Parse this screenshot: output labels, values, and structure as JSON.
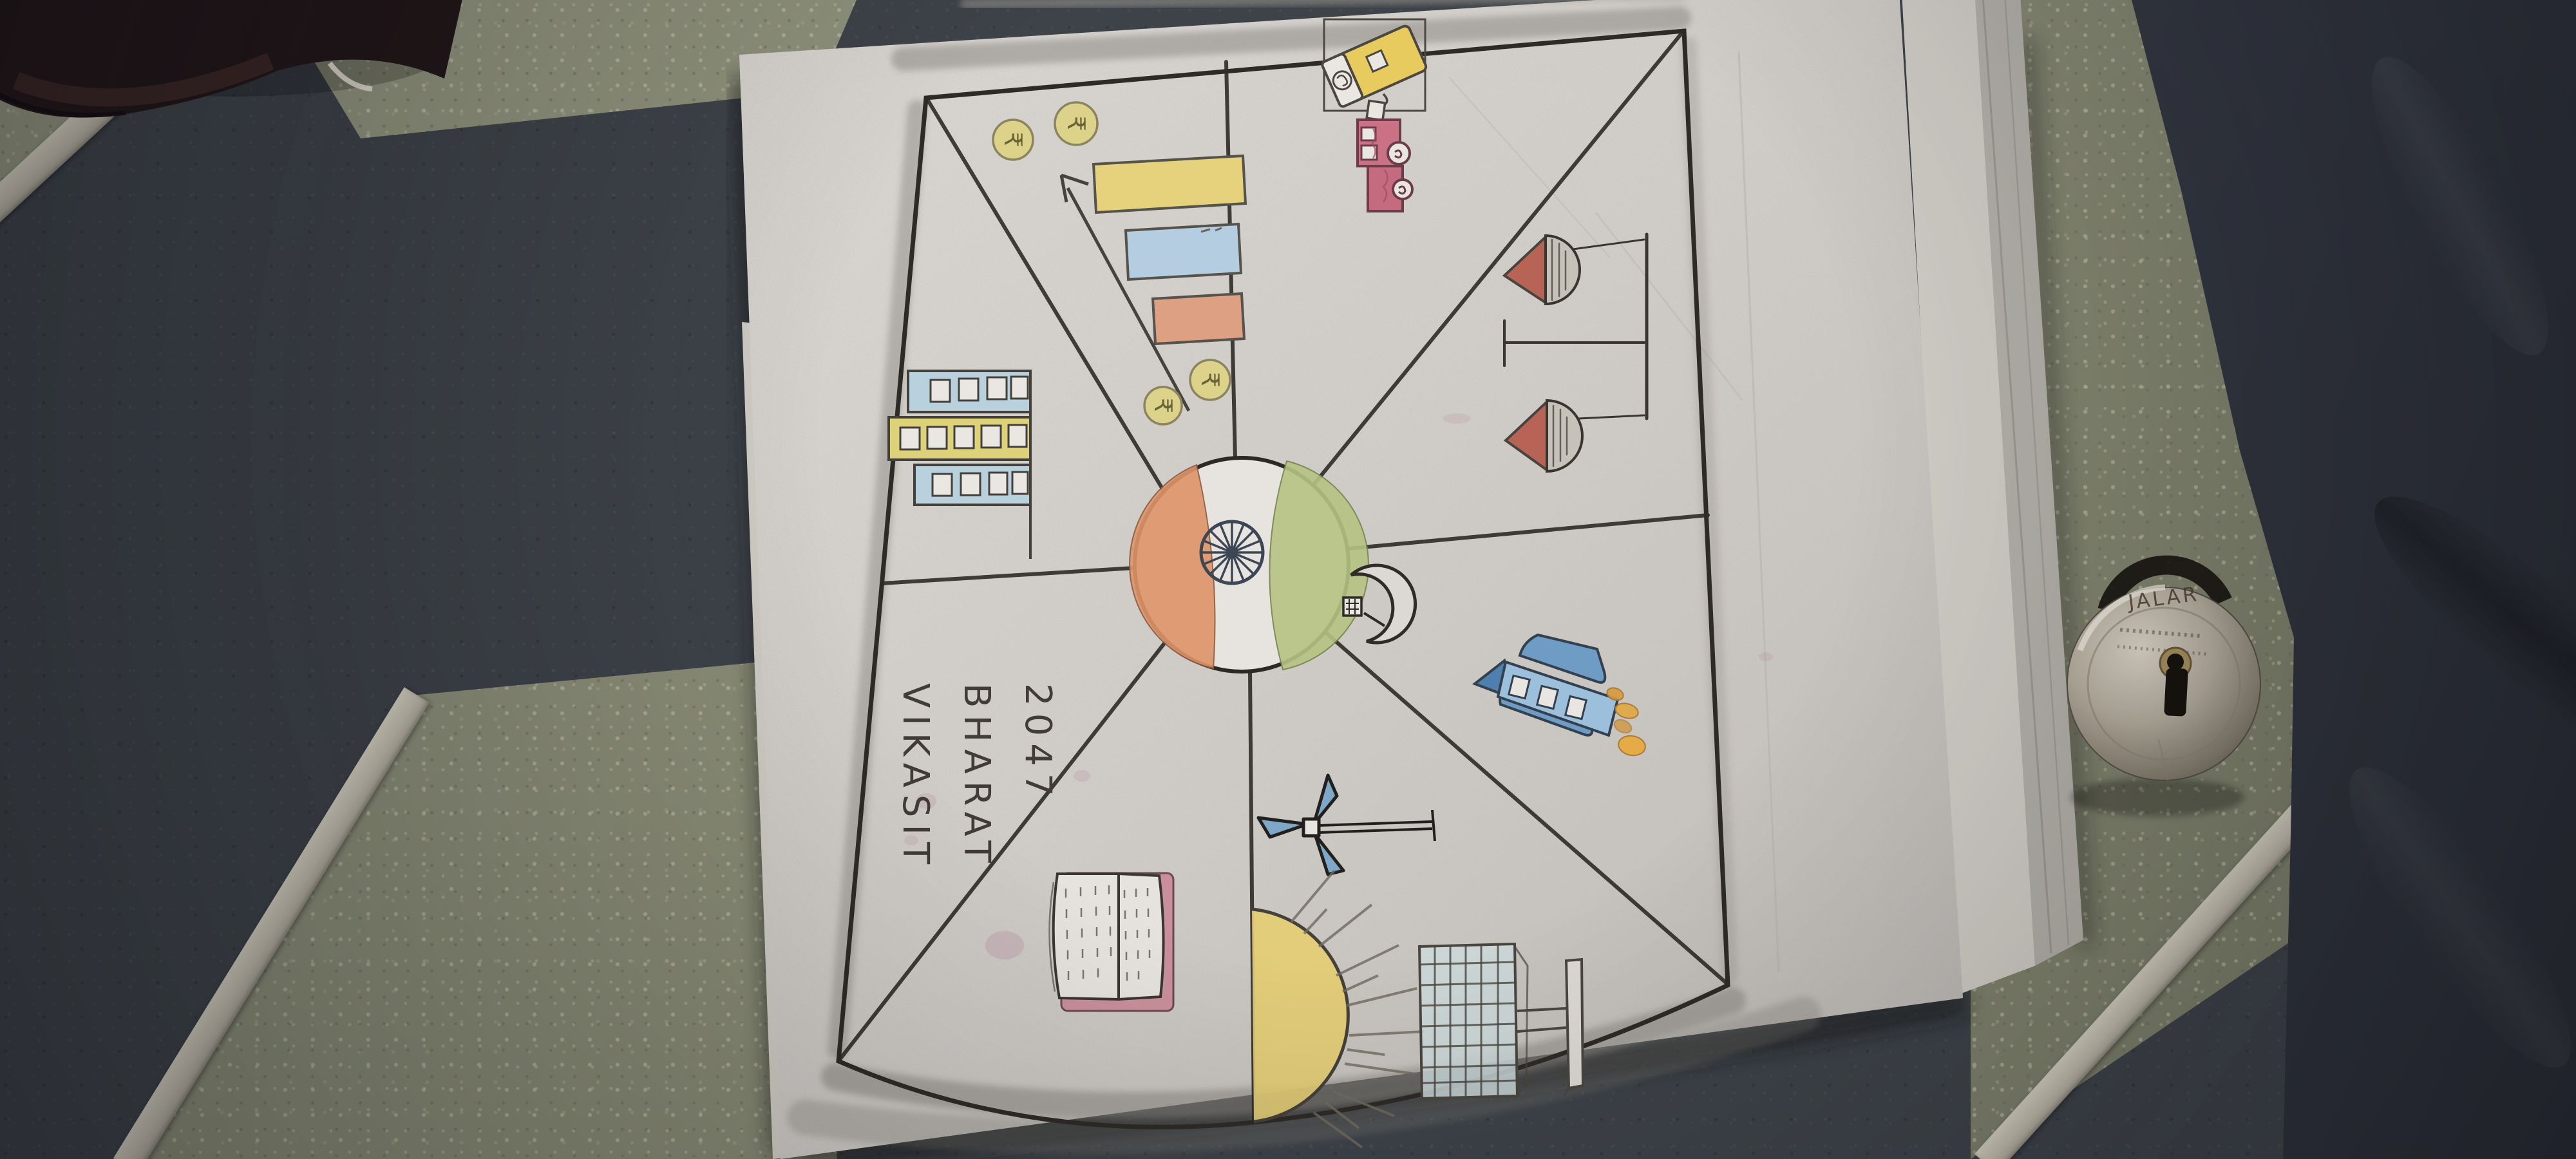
{
  "photo": {
    "description": "Photograph of a child's hand-drawn 'Viksit Bharat 2047' poster lying sideways on a tiled floor, with a round padlock and dark cloth at right",
    "floor": {
      "tile_dark": "#3e4349",
      "tile_green": "#8b8e76",
      "grout": "#c8c3b4"
    },
    "paper": {
      "color": "#e7e3df",
      "pencil": "#2e2b27"
    },
    "poster": {
      "title_lines": [
        "VIKASIT",
        "BHARAT",
        "2047"
      ],
      "flag_colors": {
        "saffron": "#df9468",
        "white": "#e7e3df",
        "green": "#b6c383",
        "chakra": "#3c4654"
      },
      "currency_symbol": "₹",
      "sections": [
        {
          "name": "economy-bar-chart",
          "items": [
            "three rising bars",
            "growth arrow",
            "four rupee coins"
          ]
        },
        {
          "name": "infrastructure-building",
          "items": [
            "multi-storey building with windows"
          ]
        },
        {
          "name": "technology-robot",
          "items": [
            "robot",
            "computer device with cable"
          ]
        },
        {
          "name": "justice-scales",
          "items": [
            "balance scale with two pans"
          ]
        },
        {
          "name": "space-rocket",
          "items": [
            "space shuttle",
            "orange flames"
          ]
        },
        {
          "name": "solar-energy",
          "items": [
            "solar panel on stand"
          ]
        },
        {
          "name": "wind-energy",
          "items": [
            "three-blade wind turbine"
          ]
        },
        {
          "name": "rising-sun",
          "items": [
            "half sun with rays"
          ]
        },
        {
          "name": "education-book",
          "items": [
            "open book"
          ]
        },
        {
          "name": "moon-mission",
          "items": [
            "crescent moon with flag"
          ]
        },
        {
          "name": "india-flag-globe",
          "items": [
            "tricolour globe with Ashoka Chakra"
          ]
        }
      ]
    },
    "padlock": {
      "brand_text": "JALAR",
      "body_color": "#b4ac9d"
    }
  }
}
